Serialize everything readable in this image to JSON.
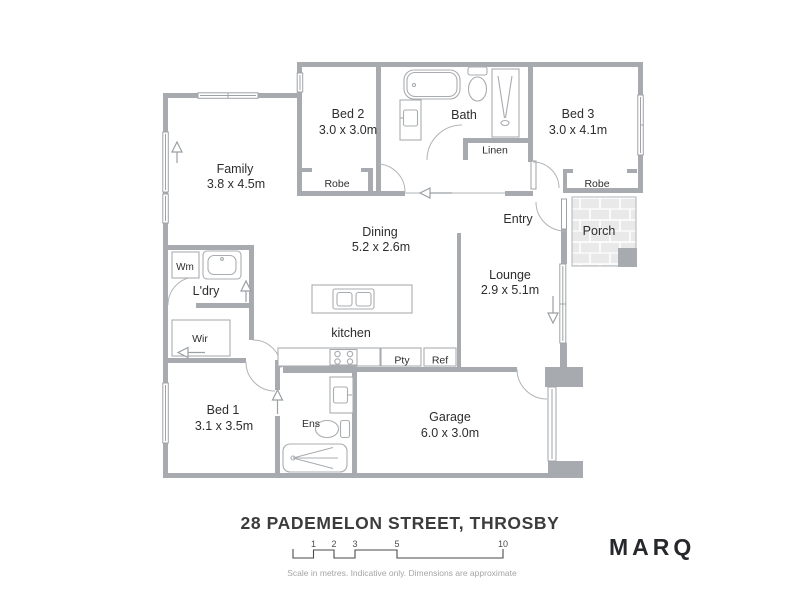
{
  "plan": {
    "rooms": {
      "family": {
        "name": "Family",
        "dims": "3.8 x 4.5m"
      },
      "bed2": {
        "name": "Bed 2",
        "dims": "3.0 x 3.0m"
      },
      "bath": {
        "name": "Bath"
      },
      "bed3": {
        "name": "Bed 3",
        "dims": "3.0 x 4.1m"
      },
      "linen": {
        "name": "Linen"
      },
      "robe_bed2": {
        "name": "Robe"
      },
      "robe_bed3": {
        "name": "Robe"
      },
      "entry": {
        "name": "Entry"
      },
      "porch": {
        "name": "Porch"
      },
      "dining": {
        "name": "Dining",
        "dims": "5.2 x 2.6m"
      },
      "lounge": {
        "name": "Lounge",
        "dims": "2.9 x 5.1m"
      },
      "laundry": {
        "name": "L'dry"
      },
      "wm": {
        "name": "Wm"
      },
      "wir": {
        "name": "Wir"
      },
      "kitchen": {
        "name": "kitchen"
      },
      "pantry": {
        "name": "Pty"
      },
      "fridge": {
        "name": "Ref"
      },
      "bed1": {
        "name": "Bed 1",
        "dims": "3.1 x 3.5m"
      },
      "ensuite": {
        "name": "Ens"
      },
      "garage": {
        "name": "Garage",
        "dims": "6.0 x 3.0m"
      }
    },
    "colors": {
      "wall": "#a7aaae",
      "fixture_line": "#a9acb0",
      "porch_tile": "#e9e9e9",
      "text": "#2d2d2d"
    }
  },
  "footer": {
    "address": "28 PADEMELON STREET, THROSBY",
    "scale_ticks": [
      "1",
      "2",
      "3",
      "5",
      "10"
    ],
    "disclaimer": "Scale in metres. Indicative only. Dimensions are approximate",
    "brand": "MARQ"
  }
}
